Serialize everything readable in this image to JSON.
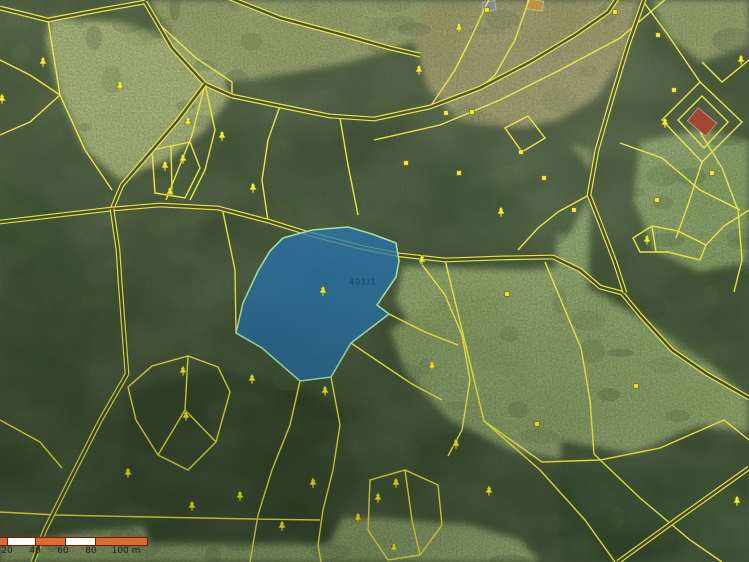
{
  "map": {
    "colors": {
      "base_forest": "#3c4c31",
      "boundary_yellow": "#e9e53c",
      "road_inner": "#414a30",
      "tree_symbol": "#f0ee2e",
      "landuse_square": "#eeea38",
      "square_border": "#77700a",
      "highlight_fill": "rgba(38,116,178,0.74)",
      "highlight_border": "#a4dfa2",
      "scale_orange": "#dd6d2f",
      "scale_white": "#ffffff",
      "scale_border": "#7a1800",
      "scale_text": "#1f1f1f"
    },
    "highlight_parcel": {
      "label": "401/1",
      "label_x": 363,
      "label_y": 282,
      "points": "283,238 312,230 348,227 372,234 396,243 399,261 396,277 377,305 389,314 351,343 331,377 300,381 262,348 236,333 243,303 258,271 270,251"
    },
    "scale_bar": {
      "x": 0,
      "y": 537,
      "bar_height": 7,
      "segments": [
        {
          "w": 7,
          "color": "orange"
        },
        {
          "w": 27,
          "color": "white"
        },
        {
          "w": 29,
          "color": "orange"
        },
        {
          "w": 29,
          "color": "white"
        },
        {
          "w": 51,
          "color": "orange"
        }
      ],
      "labels": [
        {
          "text": "20",
          "x": 7
        },
        {
          "text": "40",
          "x": 35
        },
        {
          "text": "60",
          "x": 63
        },
        {
          "text": "80",
          "x": 91
        },
        {
          "text": "100 m",
          "x": 126
        }
      ]
    },
    "symbols": {
      "trees": [
        [
          43,
          62
        ],
        [
          120,
          86
        ],
        [
          188,
          122
        ],
        [
          222,
          136
        ],
        [
          165,
          166
        ],
        [
          183,
          159
        ],
        [
          170,
          192
        ],
        [
          253,
          188
        ],
        [
          2,
          99
        ],
        [
          459,
          28
        ],
        [
          419,
          70
        ],
        [
          501,
          212
        ],
        [
          422,
          260
        ],
        [
          647,
          240
        ],
        [
          323,
          291
        ],
        [
          183,
          371
        ],
        [
          252,
          379
        ],
        [
          325,
          391
        ],
        [
          186,
          416
        ],
        [
          128,
          473
        ],
        [
          313,
          483
        ],
        [
          192,
          506
        ],
        [
          240,
          496
        ],
        [
          282,
          526
        ],
        [
          358,
          518
        ],
        [
          432,
          366
        ],
        [
          456,
          444
        ],
        [
          489,
          491
        ],
        [
          396,
          483
        ],
        [
          378,
          498
        ],
        [
          394,
          548
        ],
        [
          737,
          501
        ],
        [
          665,
          123
        ],
        [
          741,
          60
        ]
      ],
      "squares": [
        [
          487,
          10
        ],
        [
          615,
          12
        ],
        [
          658,
          35
        ],
        [
          674,
          90
        ],
        [
          472,
          112
        ],
        [
          446,
          113
        ],
        [
          521,
          152
        ],
        [
          544,
          178
        ],
        [
          406,
          163
        ],
        [
          459,
          173
        ],
        [
          574,
          210
        ],
        [
          657,
          200
        ],
        [
          712,
          173
        ],
        [
          507,
          294
        ],
        [
          636,
          386
        ],
        [
          537,
          424
        ]
      ]
    },
    "buildings": [
      {
        "cx": 489,
        "cy": 6,
        "w": 13,
        "h": 9,
        "rot": -8,
        "fill": "#7b8494"
      },
      {
        "cx": 535,
        "cy": 5,
        "w": 16,
        "h": 10,
        "rot": 8,
        "fill": "#bf8a3a"
      },
      {
        "cx": 702,
        "cy": 122,
        "w": 24,
        "h": 17,
        "rot": 40,
        "fill": "#9c3b26"
      }
    ],
    "geometry": {
      "patches": [
        {
          "pts": "50,18 120,22 190,42 225,68 228,100 205,130 168,160 120,180 85,150 60,95 46,40",
          "fill": "#a8b273"
        },
        {
          "pts": "150,0 430,0 420,40 350,62 285,74 232,82 196,58 158,22",
          "fill": "#98a066"
        },
        {
          "pts": "430,0 640,0 626,52 598,96 558,120 508,130 458,118 428,88 414,42",
          "fill": "#9d9766"
        },
        {
          "pts": "652,0 749,0 749,45 702,62 666,36",
          "fill": "#95a067"
        },
        {
          "pts": "640,142 700,130 749,142 749,262 700,272 654,250 634,200",
          "fill": "#87a065"
        },
        {
          "pts": "558,140 592,150 588,290 556,280",
          "fill": "#8da66a"
        },
        {
          "pts": "403,266 470,268 525,270 558,268 545,302 500,332 452,346 414,332 396,300",
          "fill": "#93a86c"
        },
        {
          "pts": "390,330 440,300 500,285 560,275 612,300 662,332 712,366 749,400 749,432 700,426 640,450 575,462 510,450 450,420 405,372",
          "fill": "#8da268"
        },
        {
          "pts": "0,562 0,545 60,535 150,525 260,518 380,518 470,525 520,540 540,562",
          "fill": "#95a96e"
        },
        {
          "pts": "0,178 60,210 100,300 80,420 40,470 0,480",
          "fill": "#35462c"
        },
        {
          "pts": "130,390 220,370 330,400 360,480 330,545 150,545 120,470",
          "fill": "#32432a"
        },
        {
          "pts": "560,440 680,460 749,480 749,562 560,562",
          "fill": "#33442b"
        },
        {
          "pts": "235,100 330,95 395,130 400,200 350,230 260,215 225,160",
          "fill": "#3a4c30"
        },
        {
          "pts": "445,120 560,130 600,180 570,235 480,240 435,190",
          "fill": "#3b4e31"
        }
      ],
      "roads": [
        "0,8 48,20 100,10 145,2",
        "145,2 172,48 205,84 232,96",
        "205,84 178,120 148,155 122,185 112,209",
        "0,222 60,215 112,209 160,205 218,208 268,221 310,234 360,247 400,255 445,260 500,258 553,257 580,270 600,287 622,293 640,315 672,350 707,374 749,398",
        "645,-3 628,45 612,98 597,150 589,195 602,228 615,262 625,293",
        "232,96 280,106 330,116 374,119 430,107 480,88 530,62 575,35 608,12 618,-3",
        "227,-3 280,18 340,34 390,48 420,55",
        "112,209 118,250 120,281 127,374 100,421 70,480 45,530 33,562",
        "618,562 680,517 749,468"
      ],
      "bounds": [
        "48,20 60,95 85,150 112,190",
        "145,2 160,25 196,58 232,82 232,96",
        "0,60 30,75 60,95",
        "0,135 30,122 60,95",
        "205,84 192,135 178,170 166,200",
        "205,84 215,130 205,170 190,200",
        "223,212 235,270 236,333",
        "268,221 262,180 268,140 280,106",
        "340,118 348,165 358,215",
        "374,140 440,125 500,100 560,70 620,38 668,-3",
        "430,107 455,70 470,40 490,-3",
        "480,88 495,75 515,40 530,-3",
        "589,195 558,212 538,228 518,250",
        "700,132 722,168 738,210 742,260 734,292",
        "640,-3 668,35 700,82",
        "749,60 722,82 702,62",
        "702,162 688,205 676,238",
        "749,210 724,226 706,245",
        "620,143 662,158 700,190 740,210",
        "420,262 445,295 462,335 470,380 462,430 448,456",
        "389,314 425,332 458,345",
        "351,343 382,364 412,384 442,400",
        "300,381 290,425 272,470 258,515 250,562",
        "331,377 340,425 333,470 323,510 318,545 321,562",
        "0,512 57,515 150,517 253,519 320,520",
        "0,420 40,442 62,468",
        "484,421 540,470 585,520 615,562",
        "594,454 640,498 690,540 722,562",
        "581,348 590,400 594,454",
        "484,421 542,462 600,460 660,448 724,420",
        "724,420 749,440",
        "445,260 462,330 484,421",
        "545,262 565,310 581,348",
        "188,356 185,410 216,442",
        "185,410 158,455",
        "171,145 172,195",
        "405,470 412,520 420,555",
        "652,226 656,252"
      ],
      "polys": [
        "128,387 152,366 188,356 218,367 230,392 216,442 188,470 158,455 136,420",
        "152,150 190,142 200,168 185,198 155,193",
        "370,480 405,470 438,485 442,525 420,555 388,560 368,530",
        "633,238 652,226 678,231 706,245 700,260 668,252 640,252",
        "505,128 528,116 545,138 522,152",
        "662,120 700,82 742,122 702,162",
        "678,120 702,96 728,122 704,148"
      ]
    }
  }
}
